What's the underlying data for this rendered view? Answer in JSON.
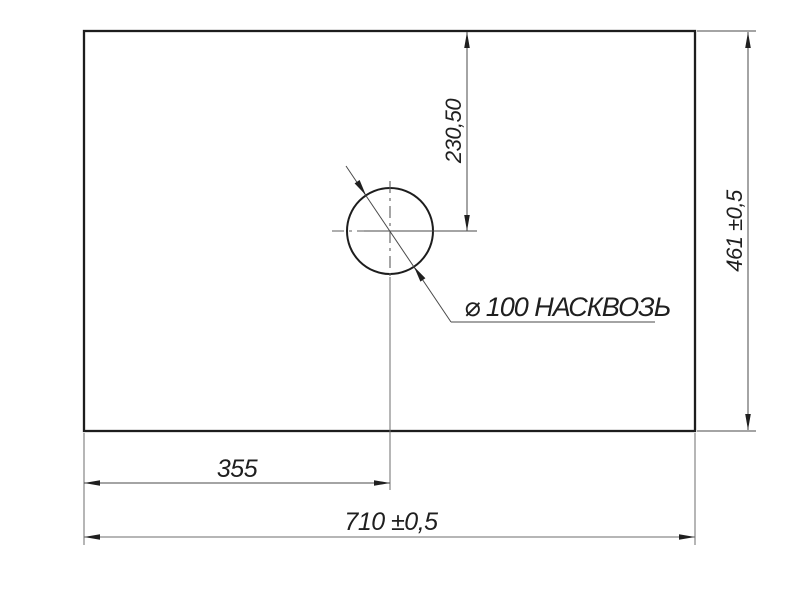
{
  "colors": {
    "background": "#ffffff",
    "outline": "#1d1d1d",
    "thin_line": "#4a4a4a",
    "text": "#1f1f1f"
  },
  "labels": {
    "hole_center_from_top": "230,50",
    "panel_height": "461 ±0,5",
    "hole_note": "⌀ 100 НАСКВОЗЬ",
    "hole_center_from_left": "355",
    "panel_width": "710 ±0,5"
  }
}
